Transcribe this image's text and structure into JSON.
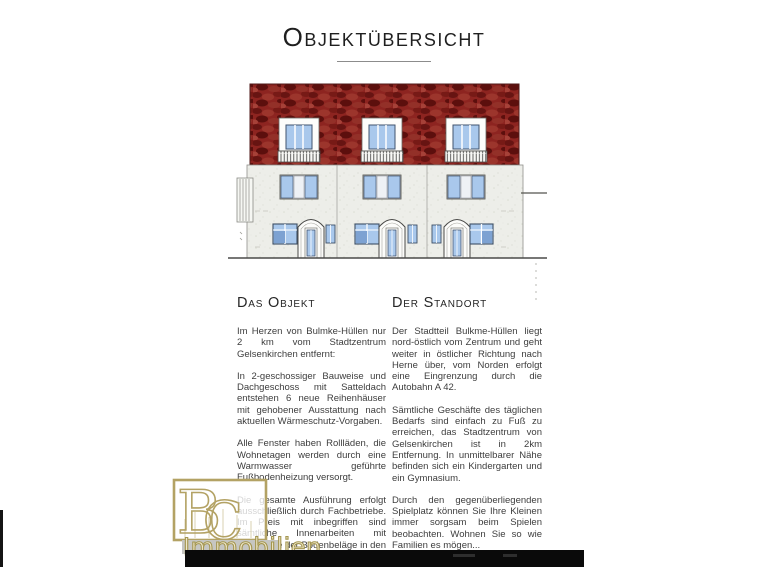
{
  "page": {
    "title": "Objektübersicht"
  },
  "columns": {
    "left": {
      "heading": "Das Objekt",
      "paragraphs": [
        "Im Herzen von Bulmke-Hüllen nur 2 km vom Stadtzentrum Gelsenkirchen entfernt:",
        "In 2-geschossiger Bauweise und Dachgeschoss mit Satteldach entstehen 6 neue Reihenhäuser mit gehobener Ausstattung nach aktuellen Wärmeschutz-Vorgaben.",
        "Alle Fenster haben Rollläden, die Wohnetagen werden durch eine Warmwasser geführte Fußbodenheizung versorgt.",
        "Die gesamte Ausführung erfolgt ausschließlich durch Fachbetriebe. Im Preis mit inbegriffen sind sämtliche Innenarbeiten mit Ausnahme der Bodenbeläge in den Wohnräumen und den Maler- und Lackierarbeiten."
      ]
    },
    "right": {
      "heading": "Der Standort",
      "paragraphs": [
        "Der Stadtteil Bulkme-Hüllen liegt nord-östlich vom Zentrum und geht weiter in östlicher Richtung nach Herne über, vom Norden erfolgt eine Eingrenzung durch die Autobahn A 42.",
        "Sämtliche Geschäfte des täglichen Bedarfs sind einfach zu Fuß zu erreichen, das Stadtzentrum von Gelsenkirchen ist in 2km Entfernung. In unmittelbarer Nähe befinden sich ein Kindergarten und ein Gymnasium.",
        "Durch den gegenüberliegenden Spielplatz können Sie Ihre Kleinen immer sorgsam beim Spielen beobachten. Wohnen Sie so wie Familien es mögen..."
      ]
    }
  },
  "watermark": {
    "letter_b": "B",
    "letter_c": "C",
    "label": "Immobilien",
    "color": "#b3a264"
  },
  "colors": {
    "roof_red": "#8d2420",
    "window_blue": "#a9c8ec",
    "accent_gold": "#b3a264"
  }
}
